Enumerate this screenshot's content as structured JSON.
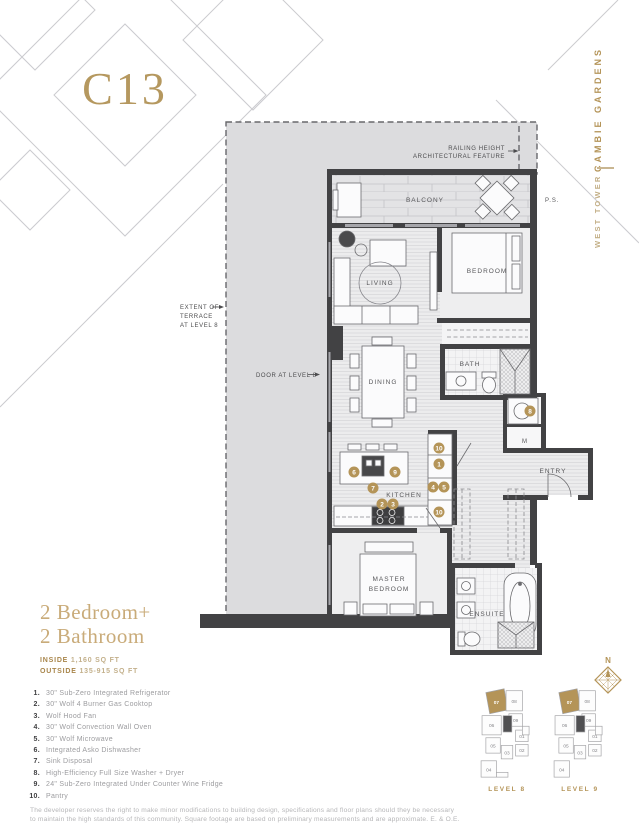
{
  "page": {
    "plan_code": "C13",
    "project": "CAMBIE GARDENS",
    "tower": "WEST TOWER"
  },
  "colors": {
    "gold": "#b49458",
    "wall": "#424244",
    "terrace": "#dcdcde"
  },
  "floorplan": {
    "rooms": {
      "balcony": "BALCONY",
      "living": "LIVING",
      "bedroom": "BEDROOM",
      "bath": "BATH",
      "dining": "DINING",
      "kitchen": "KITCHEN",
      "entry": "ENTRY",
      "master1": "MASTER",
      "master2": "BEDROOM",
      "ensuite": "ENSUITE",
      "ps": "P.S.",
      "mech": "M"
    },
    "annotations": {
      "railing1": "RAILING HEIGHT",
      "railing2": "ARCHITECTURAL FEATURE",
      "terrace1": "EXTENT OF",
      "terrace2": "TERRACE",
      "terrace3": "AT LEVEL 8",
      "door": "DOOR AT LEVEL 8"
    },
    "markers": [
      "10",
      "1",
      "4",
      "5",
      "10",
      "6",
      "9",
      "7",
      "2",
      "3",
      "8"
    ]
  },
  "summary": {
    "title_line1": "2 Bedroom+",
    "title_line2": "2 Bathroom",
    "inside_label": "INSIDE",
    "inside_value": "1,160 SQ FT",
    "outside_label": "OUTSIDE",
    "outside_value": "135-915 SQ FT"
  },
  "features": [
    {
      "num": "1.",
      "text": "30\" Sub-Zero Integrated Refrigerator"
    },
    {
      "num": "2.",
      "text": "30\" Wolf 4 Burner Gas Cooktop"
    },
    {
      "num": "3.",
      "text": "Wolf Hood Fan"
    },
    {
      "num": "4.",
      "text": "30\" Wolf Convection Wall Oven"
    },
    {
      "num": "5.",
      "text": "30\" Wolf Microwave"
    },
    {
      "num": "6.",
      "text": "Integrated Asko Dishwasher"
    },
    {
      "num": "7.",
      "text": "Sink Disposal"
    },
    {
      "num": "8.",
      "text": "High-Efficiency Full Size Washer + Dryer"
    },
    {
      "num": "9.",
      "text": "24\" Sub-Zero Integrated Under Counter Wine Fridge"
    },
    {
      "num": "10.",
      "text": "Pantry"
    }
  ],
  "disclaimer": {
    "line1": "The developer reserves the right to make minor modifications to building design, specifications and floor plans should they be necessary",
    "line2": "to maintain the high standards of this community. Square footage are based on preliminary measurements and are approximate. E. & O.E."
  },
  "keyplans": {
    "plans": [
      {
        "label": "LEVEL 8",
        "units": [
          "07",
          "08",
          "09",
          "06",
          "01",
          "05",
          "02",
          "03",
          "04"
        ]
      },
      {
        "label": "LEVEL 9",
        "units": [
          "07",
          "08",
          "09",
          "06",
          "01",
          "05",
          "02",
          "03",
          "04"
        ]
      }
    ]
  },
  "compass": {
    "label": "N"
  }
}
